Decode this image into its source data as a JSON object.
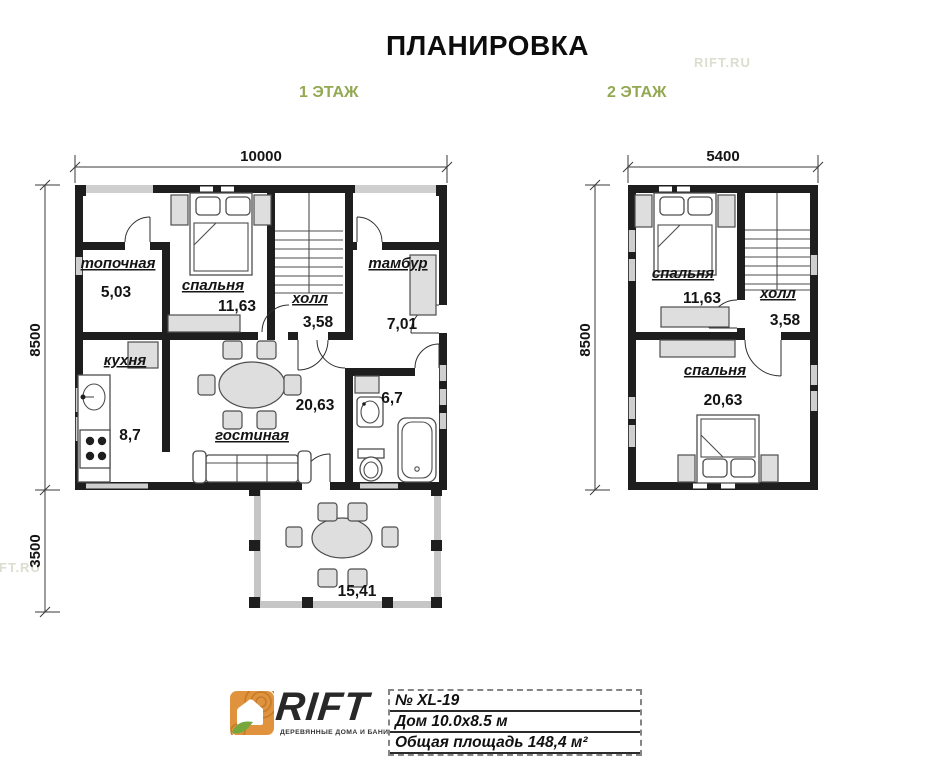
{
  "title": "ПЛАНИРОВКА",
  "watermark": "RIFT.RU",
  "colors": {
    "accent_green": "#92a851",
    "wall": "#1e1e1e",
    "logo_orange": "#e0923d",
    "leaf_green": "#76a73c"
  },
  "floor1": {
    "label": "1 ЭТАЖ",
    "dims": {
      "width": "10000",
      "height": "8500",
      "terrace": "3500"
    },
    "rooms": {
      "boiler": {
        "name": "топочная",
        "area": "5,03"
      },
      "bedroom": {
        "name": "спальня",
        "area": "11,63"
      },
      "hall": {
        "name": "холл",
        "area": "3,58"
      },
      "vestibule": {
        "name": "тамбур",
        "area": "7,01"
      },
      "kitchen": {
        "name": "кухня",
        "area": "8,7"
      },
      "living": {
        "name": "гостиная",
        "area": "20,63"
      },
      "bathroom": {
        "area": "6,7"
      },
      "terrace": {
        "area": "15,41"
      }
    }
  },
  "floor2": {
    "label": "2 ЭТАЖ",
    "dims": {
      "width": "5400",
      "height": "8500"
    },
    "rooms": {
      "bedroom1": {
        "name": "спальня",
        "area": "11,63"
      },
      "hall": {
        "name": "холл",
        "area": "3,58"
      },
      "bedroom2": {
        "name": "спальня",
        "area": "20,63"
      }
    }
  },
  "footer": {
    "logo_text": "RIFT",
    "logo_tagline": "ДЕРЕВЯННЫЕ ДОМА И БАНИ",
    "info_rows": [
      "№ XL-19",
      "Дом 10.0x8.5 м",
      "Общая площадь 148,4 м²"
    ]
  }
}
